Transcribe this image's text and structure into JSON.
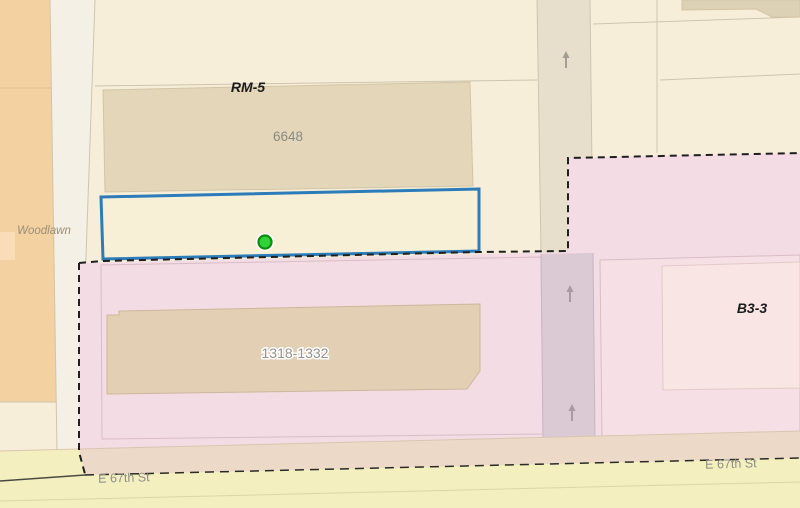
{
  "map": {
    "zone_labels": [
      {
        "id": "rm5",
        "text": "RM-5"
      },
      {
        "id": "b3-3",
        "text": "B3-3"
      }
    ],
    "street_labels": [
      {
        "id": "woodlawn",
        "text": "Woodlawn"
      },
      {
        "id": "e67th-left",
        "text": "E 67th St"
      },
      {
        "id": "e67th-right",
        "text": "E 67th St"
      }
    ],
    "building_labels": [
      {
        "id": "bldg-6648",
        "text": "6648"
      },
      {
        "id": "bldg-1318",
        "text": "1318-1332"
      }
    ],
    "selection": {
      "marker": "green-circle-marker",
      "outline_color": "#2b7cb9",
      "marker_fill": "#2fd237",
      "marker_stroke": "#0f8c12"
    },
    "icons": [
      "one-way-arrow-icon"
    ],
    "colors": {
      "base_beige": "#f7eed9",
      "zone_pink": "#f3dce3",
      "orange_parcel": "#f3d1a0",
      "street_white": "#f4f0e5",
      "street_top_tan": "#e7decb",
      "street_mauve": "#dbc9d3",
      "street_band_tan": "#edd9c7",
      "street_band_yellow": "#f3efbe",
      "building_tan": "#e4d7b9",
      "boundary_dash": "#1f1f1f"
    }
  }
}
